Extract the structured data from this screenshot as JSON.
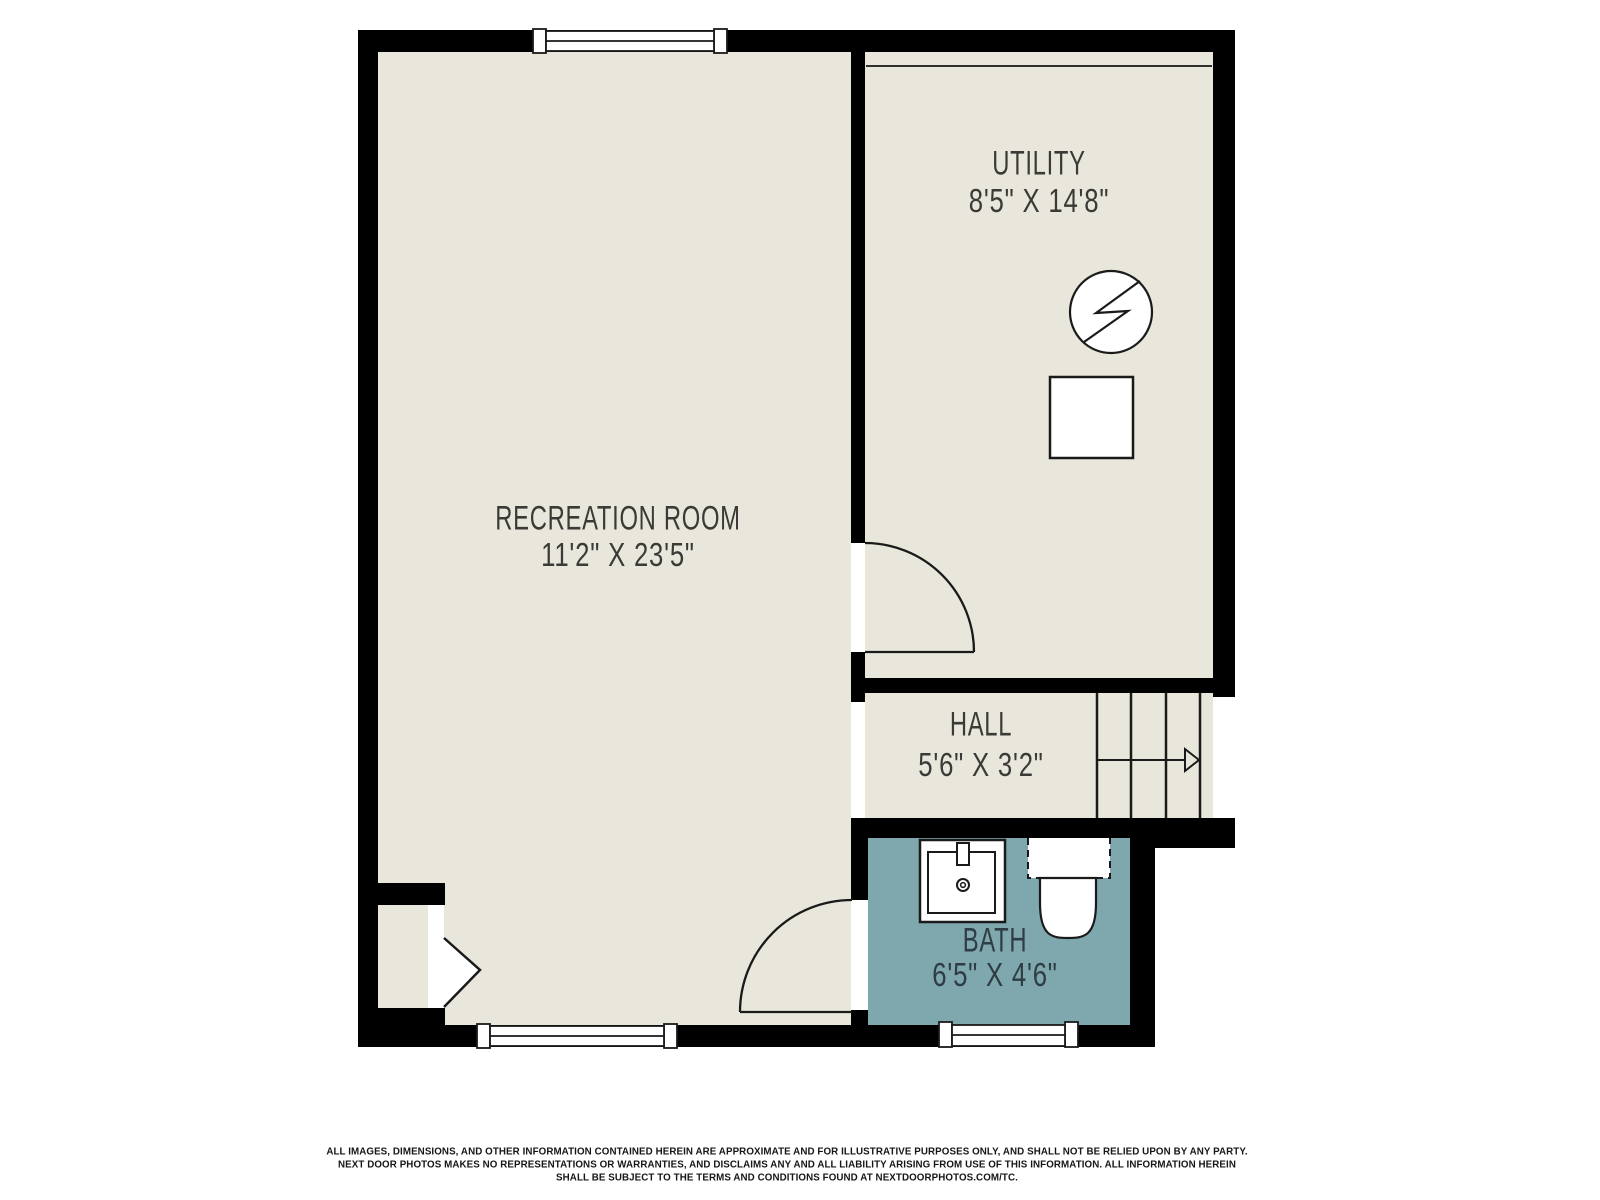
{
  "plan": {
    "title": "basement floor plan",
    "rooms": {
      "recreation": {
        "name": "RECREATION ROOM",
        "dims": "11'2\" X 23'5\""
      },
      "utility": {
        "name": "UTILITY",
        "dims": "8'5\" X 14'8\""
      },
      "hall": {
        "name": "HALL",
        "dims": "5'6\" X 3'2\""
      },
      "bath": {
        "name": "BATH",
        "dims": "6'5\" X 4'6\""
      }
    },
    "icons": {
      "water_heater": "water-heater-icon",
      "appliance": "appliance-square-icon",
      "sink": "sink-icon",
      "toilet": "toilet-icon",
      "stairs": "stairs-up-arrow-icon",
      "closet_door": "bifold-door-icon",
      "doors": "door-swing-icon",
      "windows": "window-icon"
    },
    "colors": {
      "floor": "#e9e7db",
      "bath_floor": "#7ea7ae",
      "wall": "#000000",
      "line": "#1a1a1a",
      "label": "#3b3a37",
      "bath_label": "#2e3d43"
    }
  },
  "footer": {
    "line1": "ALL IMAGES, DIMENSIONS, AND OTHER INFORMATION CONTAINED HEREIN ARE APPROXIMATE AND FOR ILLUSTRATIVE PURPOSES ONLY, AND SHALL NOT BE RELIED UPON BY ANY PARTY.",
    "line2": "NEXT DOOR PHOTOS MAKES NO REPRESENTATIONS OR WARRANTIES, AND DISCLAIMS ANY AND ALL LIABILITY ARISING FROM USE OF THIS INFORMATION. ALL INFORMATION HEREIN",
    "line3": "SHALL BE SUBJECT TO THE TERMS AND CONDITIONS FOUND AT NEXTDOORPHOTOS.COM/TC."
  }
}
